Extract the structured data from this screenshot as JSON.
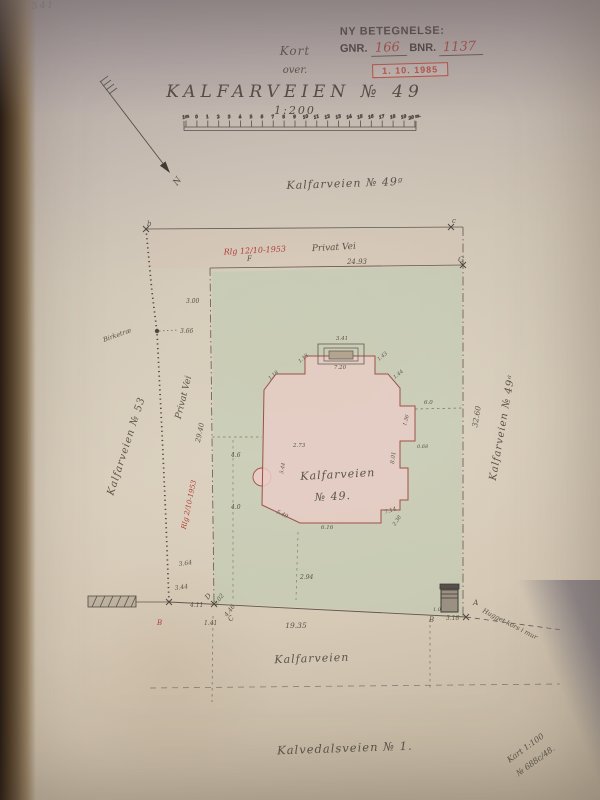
{
  "photo": {
    "pencil_note": "541"
  },
  "stamp": {
    "line1": "NY BETEGNELSE:",
    "gnr_label": "GNR.",
    "gnr_value": "166",
    "bnr_label": "BNR.",
    "bnr_value": "1137",
    "date_stamp": "1. 10. 1985"
  },
  "title": {
    "kort": "Kort",
    "over": "over.",
    "name": "KALFARVEIEN  № 49",
    "scale": "1:200"
  },
  "north": {
    "label": "N"
  },
  "map": {
    "colors": {
      "ink": "#5a5348",
      "red": "#b23f38",
      "building_fill": "#e8ccc5",
      "building_stroke": "#9c5148",
      "green_wash": "#b5cbb0",
      "pink_wash": "#dbbfae"
    },
    "scale_bar": {
      "ticks": [
        "1m",
        "0",
        "1",
        "2",
        "3",
        "4",
        "5",
        "6",
        "7",
        "8",
        "9",
        "10",
        "11",
        "12",
        "13",
        "14",
        "15",
        "16",
        "17",
        "18",
        "19",
        "20 m."
      ]
    },
    "labels": [
      {
        "t": "Kalfarveien  № 49ᵍ",
        "x": 345,
        "y": 187,
        "s": 11,
        "r": -2,
        "a": "middle",
        "cls": "street"
      },
      {
        "t": "Rlg 12/10-1953",
        "x": 255,
        "y": 253,
        "s": 8,
        "r": -3,
        "a": "middle",
        "c": "red"
      },
      {
        "t": "Privat Vei",
        "x": 334,
        "y": 250,
        "s": 9,
        "r": -3,
        "a": "middle"
      },
      {
        "t": "24.93",
        "x": 357,
        "y": 264,
        "s": 7,
        "a": "middle"
      },
      {
        "t": "Privat Vei",
        "x": 186,
        "y": 398,
        "s": 9,
        "r": -76,
        "a": "middle"
      },
      {
        "t": "29.40",
        "x": 202,
        "y": 433,
        "s": 7,
        "r": -78,
        "a": "middle"
      },
      {
        "t": "Kalfarveien  № 53",
        "x": 129,
        "y": 447,
        "s": 10,
        "r": -72,
        "a": "middle",
        "cls": "street"
      },
      {
        "t": "Birketræ",
        "x": 104,
        "y": 342,
        "s": 6.5,
        "r": -20
      },
      {
        "t": "3.66",
        "x": 180,
        "y": 333,
        "s": 6
      },
      {
        "t": "3.00",
        "x": 186,
        "y": 303,
        "s": 6
      },
      {
        "t": "Kalfarveien",
        "x": 338,
        "y": 478,
        "s": 11,
        "r": -3,
        "a": "middle",
        "cls": "street"
      },
      {
        "t": "№ 49.",
        "x": 333,
        "y": 500,
        "s": 11,
        "r": -3,
        "a": "middle",
        "cls": "street"
      },
      {
        "t": "32.60",
        "x": 479,
        "y": 417,
        "s": 7.5,
        "r": -80,
        "a": "middle"
      },
      {
        "t": "Kalfarveien  № 49ᵃ",
        "x": 505,
        "y": 428,
        "s": 10,
        "r": -80,
        "a": "middle",
        "cls": "street"
      },
      {
        "t": "19.35",
        "x": 296,
        "y": 628,
        "s": 7.5,
        "a": "middle"
      },
      {
        "t": "Kalfarveien",
        "x": 312,
        "y": 662,
        "s": 11,
        "r": -2,
        "a": "middle",
        "cls": "street"
      },
      {
        "t": "Kalvedalsveien  № 1.",
        "x": 345,
        "y": 752,
        "s": 11.5,
        "r": -2,
        "a": "middle",
        "cls": "street"
      },
      {
        "t": "Hugget kors i mur",
        "x": 482,
        "y": 612,
        "s": 6.5,
        "r": 27
      },
      {
        "t": "Kart 1:100",
        "x": 527,
        "y": 750,
        "s": 8,
        "r": -36,
        "a": "middle"
      },
      {
        "t": "№ 688c/48.",
        "x": 537,
        "y": 763,
        "s": 8,
        "r": -36,
        "a": "middle"
      },
      {
        "t": "Rlg 2/10-1953",
        "x": 191,
        "y": 505,
        "s": 7,
        "r": -78,
        "a": "middle",
        "c": "red"
      },
      {
        "t": "4.6",
        "x": 231,
        "y": 457,
        "s": 6
      },
      {
        "t": "4.0",
        "x": 231,
        "y": 509,
        "s": 6
      },
      {
        "t": "3.64",
        "x": 179,
        "y": 566,
        "s": 6,
        "r": -8
      },
      {
        "t": "3.44",
        "x": 175,
        "y": 590,
        "s": 6,
        "r": -8
      },
      {
        "t": "2.94",
        "x": 300,
        "y": 579,
        "s": 6
      },
      {
        "t": "4.11",
        "x": 190,
        "y": 607,
        "s": 6
      },
      {
        "t": "1.41",
        "x": 204,
        "y": 625,
        "s": 6
      },
      {
        "t": "5.02",
        "x": 216,
        "y": 606,
        "s": 6,
        "r": -52
      },
      {
        "t": "4.46",
        "x": 227,
        "y": 617,
        "s": 6,
        "r": -52
      },
      {
        "t": "3.18",
        "x": 446,
        "y": 620,
        "s": 6
      },
      {
        "t": "1.0",
        "x": 433,
        "y": 611,
        "s": 5
      },
      {
        "t": "3.41",
        "x": 342,
        "y": 340,
        "s": 5.5,
        "a": "middle"
      },
      {
        "t": "7.20",
        "x": 340,
        "y": 369,
        "s": 5.5,
        "a": "middle"
      },
      {
        "t": "1.13",
        "x": 300,
        "y": 363,
        "s": 5,
        "r": -40
      },
      {
        "t": "1.43",
        "x": 379,
        "y": 361,
        "s": 5,
        "r": -40
      },
      {
        "t": "1.18",
        "x": 270,
        "y": 380,
        "s": 5,
        "r": -40
      },
      {
        "t": "1.44",
        "x": 395,
        "y": 379,
        "s": 5,
        "r": -40
      },
      {
        "t": "6.0",
        "x": 424,
        "y": 404,
        "s": 5.5
      },
      {
        "t": "1.36",
        "x": 406,
        "y": 426,
        "s": 5,
        "r": -75
      },
      {
        "t": "0.68",
        "x": 417,
        "y": 448,
        "s": 5
      },
      {
        "t": "8.01",
        "x": 394,
        "y": 464,
        "s": 5.5,
        "r": -83
      },
      {
        "t": "2.73",
        "x": 293,
        "y": 447,
        "s": 5.5
      },
      {
        "t": "5.44",
        "x": 283,
        "y": 474,
        "s": 5,
        "r": -80
      },
      {
        "t": "5.49",
        "x": 276,
        "y": 513,
        "s": 5.5,
        "r": 25
      },
      {
        "t": "6.16",
        "x": 321,
        "y": 529,
        "s": 5.5
      },
      {
        "t": "7.14",
        "x": 385,
        "y": 514,
        "s": 5.5,
        "r": -18
      },
      {
        "t": "2.38",
        "x": 395,
        "y": 526,
        "s": 5,
        "r": -55
      }
    ],
    "markers": [
      {
        "t": "b",
        "x": 147,
        "y": 226,
        "s": 7
      },
      {
        "t": "c",
        "x": 452,
        "y": 223,
        "s": 7
      },
      {
        "t": "G",
        "x": 458,
        "y": 262,
        "s": 7.5
      },
      {
        "t": "F",
        "x": 247,
        "y": 261,
        "s": 7
      },
      {
        "t": "D",
        "x": 208,
        "y": 600,
        "s": 7,
        "r": -50
      },
      {
        "t": "C",
        "x": 231,
        "y": 622,
        "s": 7,
        "r": -50
      },
      {
        "t": "A",
        "x": 473,
        "y": 605,
        "s": 7.5
      },
      {
        "t": "B",
        "x": 429,
        "y": 622,
        "s": 7
      },
      {
        "t": "B",
        "x": 157,
        "y": 625,
        "s": 7,
        "c": "red"
      }
    ]
  }
}
